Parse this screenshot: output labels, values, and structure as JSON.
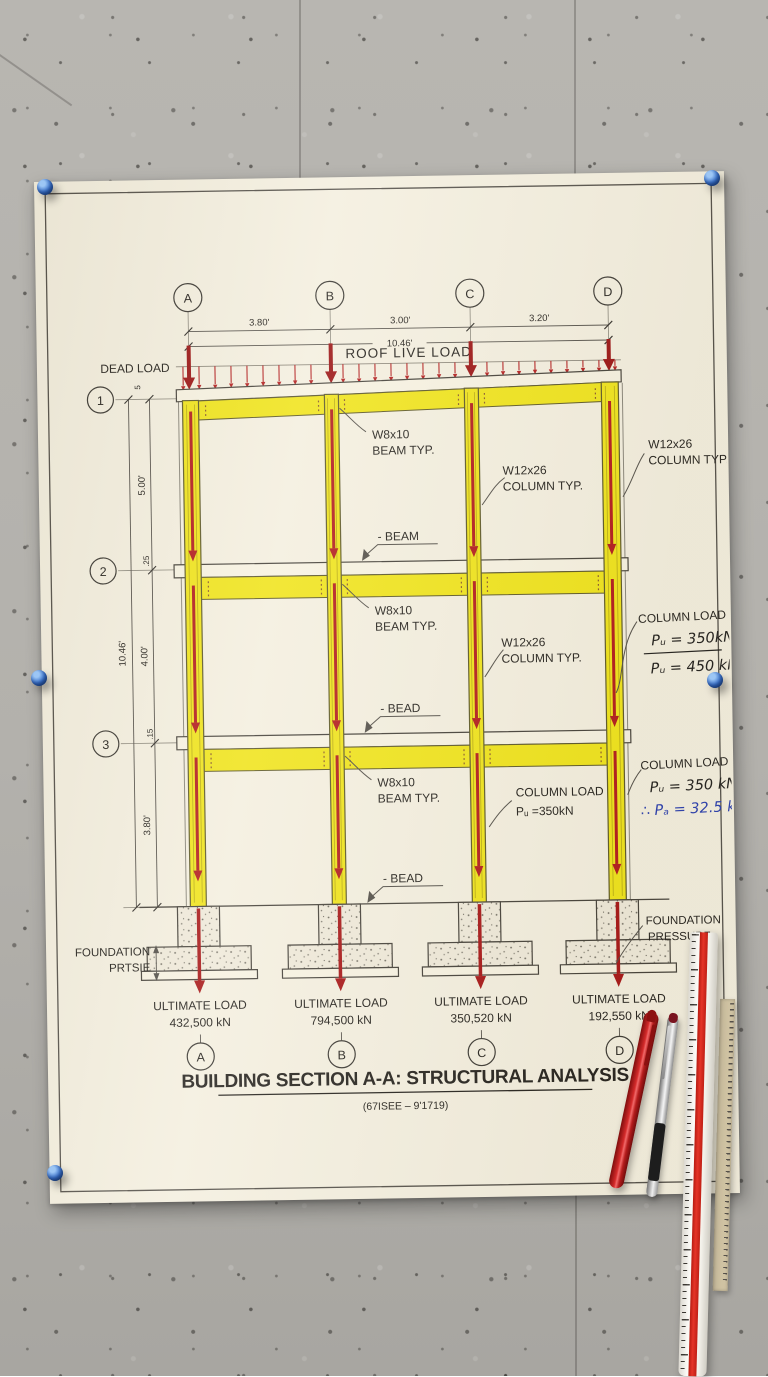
{
  "drawing": {
    "title": "BUILDING SECTION A-A: STRUCTURAL ANALYSIS",
    "subtitle": "(67ISEE – 9'1719)",
    "grid_top": [
      "A",
      "B",
      "C",
      "D"
    ],
    "grid_bottom": [
      "A",
      "B",
      "C",
      "D"
    ],
    "levels": [
      "1",
      "2",
      "3"
    ],
    "dims": {
      "top_ab": "3.80'",
      "top_bc": "3.00'",
      "top_cd": "3.20'",
      "top_total": "10.46'",
      "story1": "5.00'",
      "story2": "4.00'",
      "left_total": "10.46'",
      "story3": "3.80'",
      "roof_small": "5",
      "slab2_small": ".25",
      "slab3_small": ".15"
    },
    "loads": {
      "dead": "DEAD LOAD",
      "roof_live": "ROOF LIVE LOAD"
    },
    "beam_typ": {
      "line1": "W8x10",
      "line2": "BEAM TYP."
    },
    "column_typ": {
      "line1": "W12x26",
      "line2": "COLUMN TYP."
    },
    "callouts": {
      "story1": "- BEAM",
      "story2": "- BEAD",
      "story3": "- BEAD"
    },
    "column_load_mid": {
      "line1": "COLUMN LOAD",
      "line2": "Pᵤ =350kN"
    },
    "column_load_right_upper": {
      "title": "COLUMN LOAD",
      "value_top": "Pᵤ = 350kN",
      "value_bottom": "Pᵤ = 450 kN"
    },
    "column_load_right_lower": {
      "title": "COLUMN LOAD",
      "value_top": "Pᵤ = 350 kN",
      "value_bottom": "∴ Pₐ = 32.5 kN"
    },
    "foundation_label_left": {
      "line1": "FOUNDATION",
      "line2": "PRTSIE"
    },
    "foundation_label_right": {
      "line1": "FOUNDATION",
      "line2": "PRESSURF"
    },
    "ultimate_loads": [
      {
        "label": "ULTIMATE LOAD",
        "value": "432,500 kN"
      },
      {
        "label": "ULTIMATE LOAD",
        "value": "794,500 kN"
      },
      {
        "label": "ULTIMATE LOAD",
        "value": "350,520 kN"
      },
      {
        "label": "ULTIMATE LOAD",
        "value": "192,550 kN"
      }
    ],
    "colors": {
      "member_yellow": "#f0e41c",
      "arrow_red": "#b31d1d",
      "ink_blue": "#2b3fae",
      "paper": "#f4efdf",
      "pin_blue": "#2e6fd4",
      "wall": "#b4b2ad"
    }
  }
}
